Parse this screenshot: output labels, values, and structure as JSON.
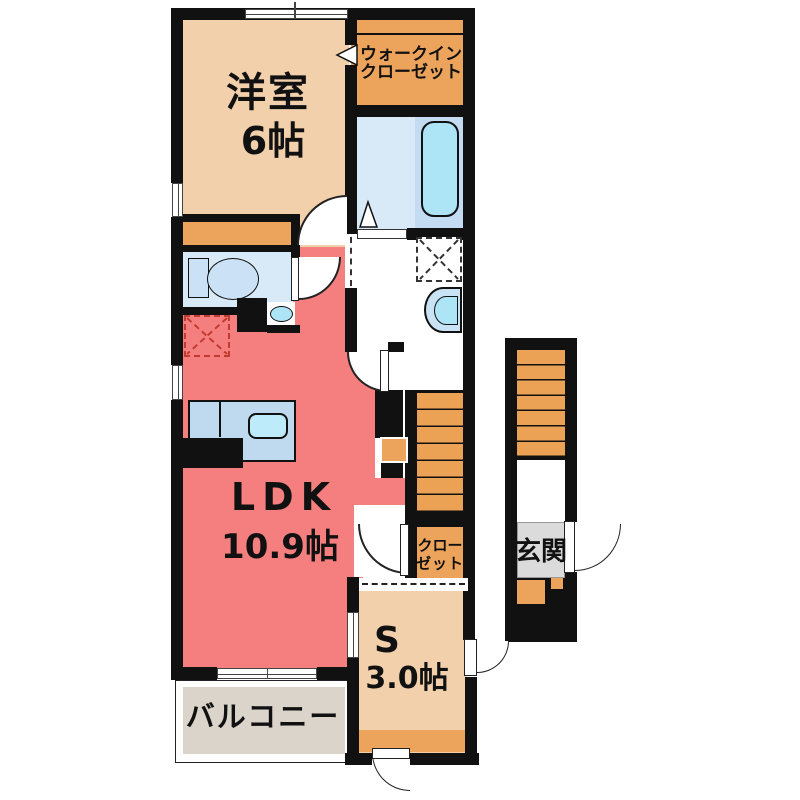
{
  "plan_title": "1LDK+S apartment floor plan",
  "rooms": {
    "western": {
      "name": "洋室",
      "size": "6帖"
    },
    "wic": {
      "line1": "ウォークイン",
      "line2": "クローゼット"
    },
    "ldk": {
      "name": "LDK",
      "size": "10.9帖"
    },
    "closet": {
      "line1": "クロー",
      "line2": "ゼット"
    },
    "entrance": {
      "name": "玄関"
    },
    "service": {
      "name": "S",
      "size": "3.0帖"
    },
    "balcony": {
      "name": "バルコニー"
    }
  },
  "fixtures": [
    "toilet-fixture",
    "bathtub-fixture",
    "vanity-basin-fixture",
    "small-basin-fixture",
    "kitchen-sink-fixture",
    "washing-machine-area",
    "refrigerator-area",
    "internal-staircase",
    "entrance-staircase",
    "folding-bath-door",
    "door-swing-arcs"
  ],
  "colors": {
    "room_tan": "#F2D0AC",
    "accent_orange": "#ECA35B",
    "ldk_red": "#F57F7F",
    "wet_floor_blue": "#D8E9F8",
    "tub_zone_blue": "#C3DCF2",
    "tub_blue": "#ADE4F6",
    "counter_blue": "#BFD9EF",
    "genkan_gray": "#DBDBDB",
    "balcony_gray": "#DAD4CA",
    "wall_black": "#111111",
    "fridge_dash_red": "#C23B30"
  }
}
